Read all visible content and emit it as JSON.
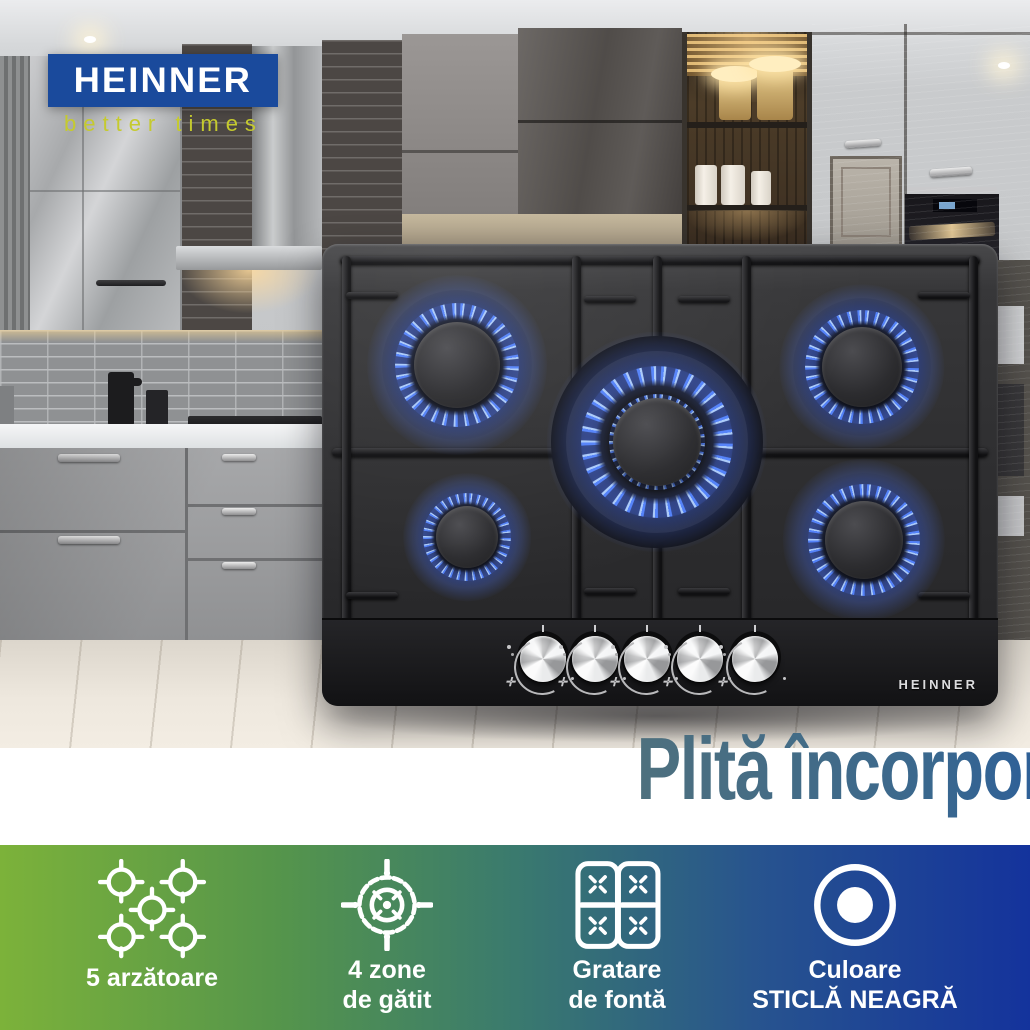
{
  "brand": {
    "name": "HEINNER",
    "tagline": "better times",
    "logo_bg_color": "#1a4a9c",
    "logo_text_color": "#ffffff",
    "tagline_color": "#c5ca2e"
  },
  "product": {
    "brand_label": "HEINNER",
    "type": "built-in gas hob on black glass",
    "burner_count": 5,
    "knob_count": 5,
    "flame_color": "#5686ff",
    "glass_color": "#242426"
  },
  "headline": {
    "text": "Plită încorporabilă pe gaz",
    "gradient_start": "#4e707e",
    "gradient_mid": "#2b5f97",
    "gradient_end": "#1c41a0"
  },
  "feature_bar": {
    "gradient": [
      "#7cb23a",
      "#55954b",
      "#3a7a6e",
      "#27538f",
      "#14339c"
    ],
    "text_color": "#ffffff",
    "items": [
      {
        "icon": "five-burners-icon",
        "line1": "5 arzătoare",
        "line2": ""
      },
      {
        "icon": "cooking-zones-icon",
        "line1": "4 zone",
        "line2": "de gătit"
      },
      {
        "icon": "cast-iron-grates-icon",
        "line1": "Gratare",
        "line2": "de fontă"
      },
      {
        "icon": "black-glass-icon",
        "line1": "Culoare",
        "line2": "STICLĂ NEAGRĂ"
      }
    ]
  }
}
